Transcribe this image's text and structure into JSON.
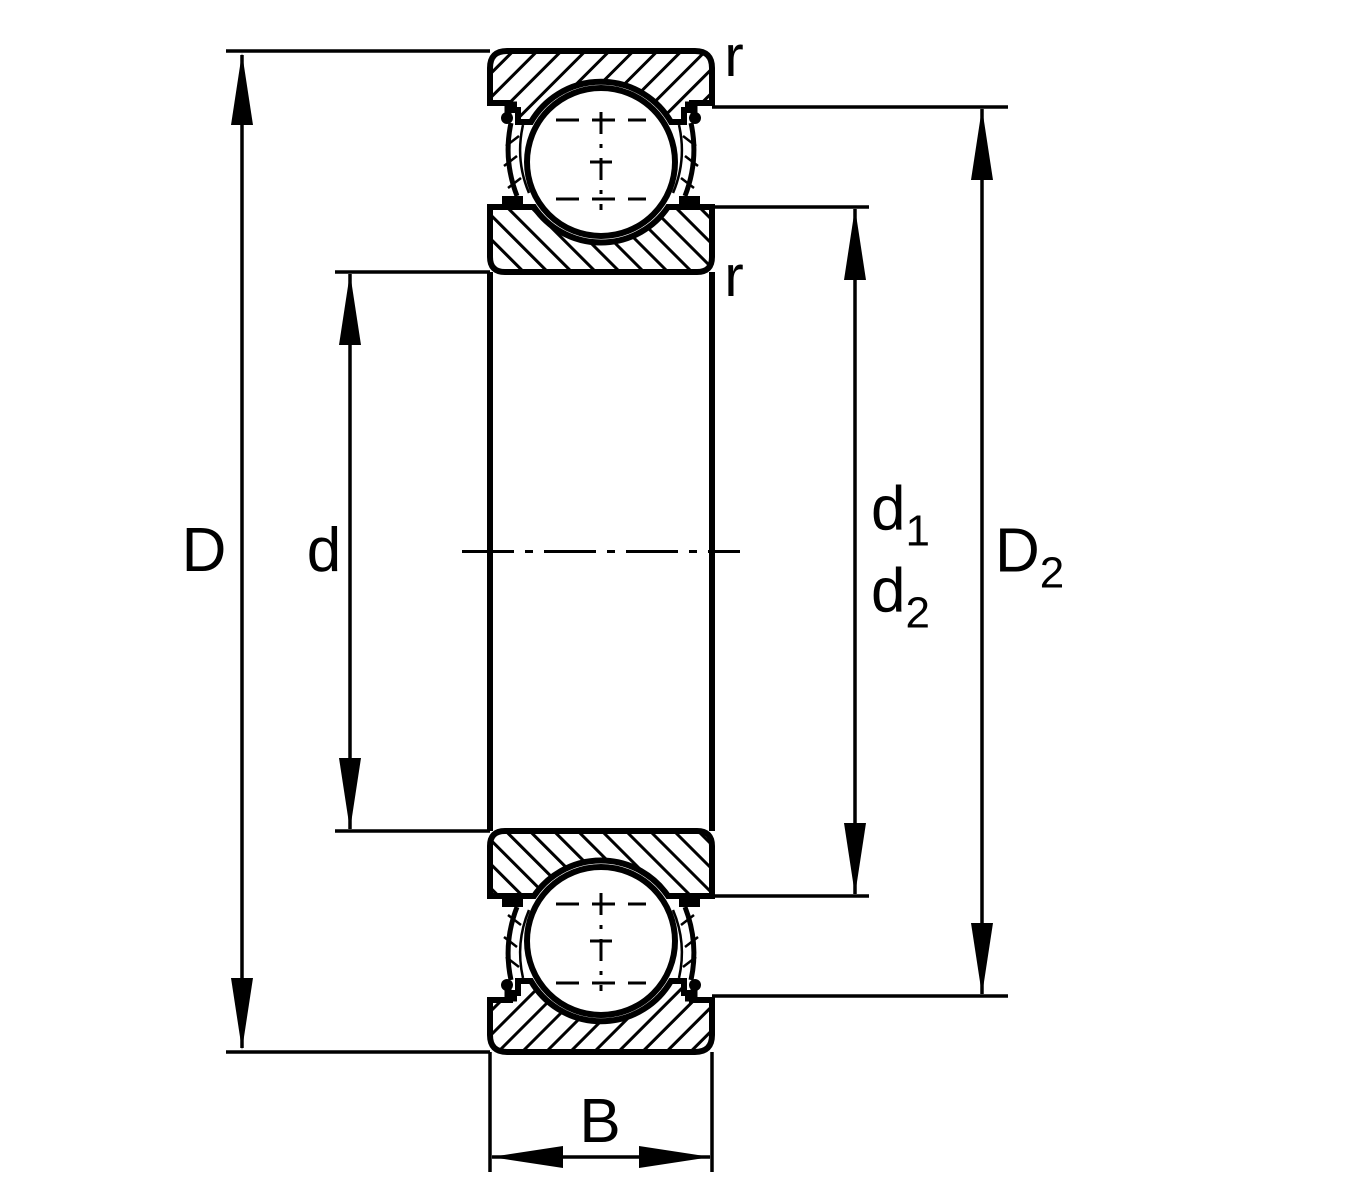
{
  "figure": {
    "kind": "bearing-cross-section-dimension-drawing",
    "colors": {
      "line": "#000000",
      "background": "#ffffff"
    }
  },
  "labels": {
    "outer_diameter": "D",
    "bore_diameter": "d",
    "recess_diameter_1": {
      "base": "d",
      "sub": "1"
    },
    "recess_diameter_2": {
      "base": "d",
      "sub": "2"
    },
    "shoulder_diameter": {
      "base": "D",
      "sub": "2"
    },
    "width": "B",
    "chamfer_outer": "r",
    "chamfer_inner": "r"
  }
}
